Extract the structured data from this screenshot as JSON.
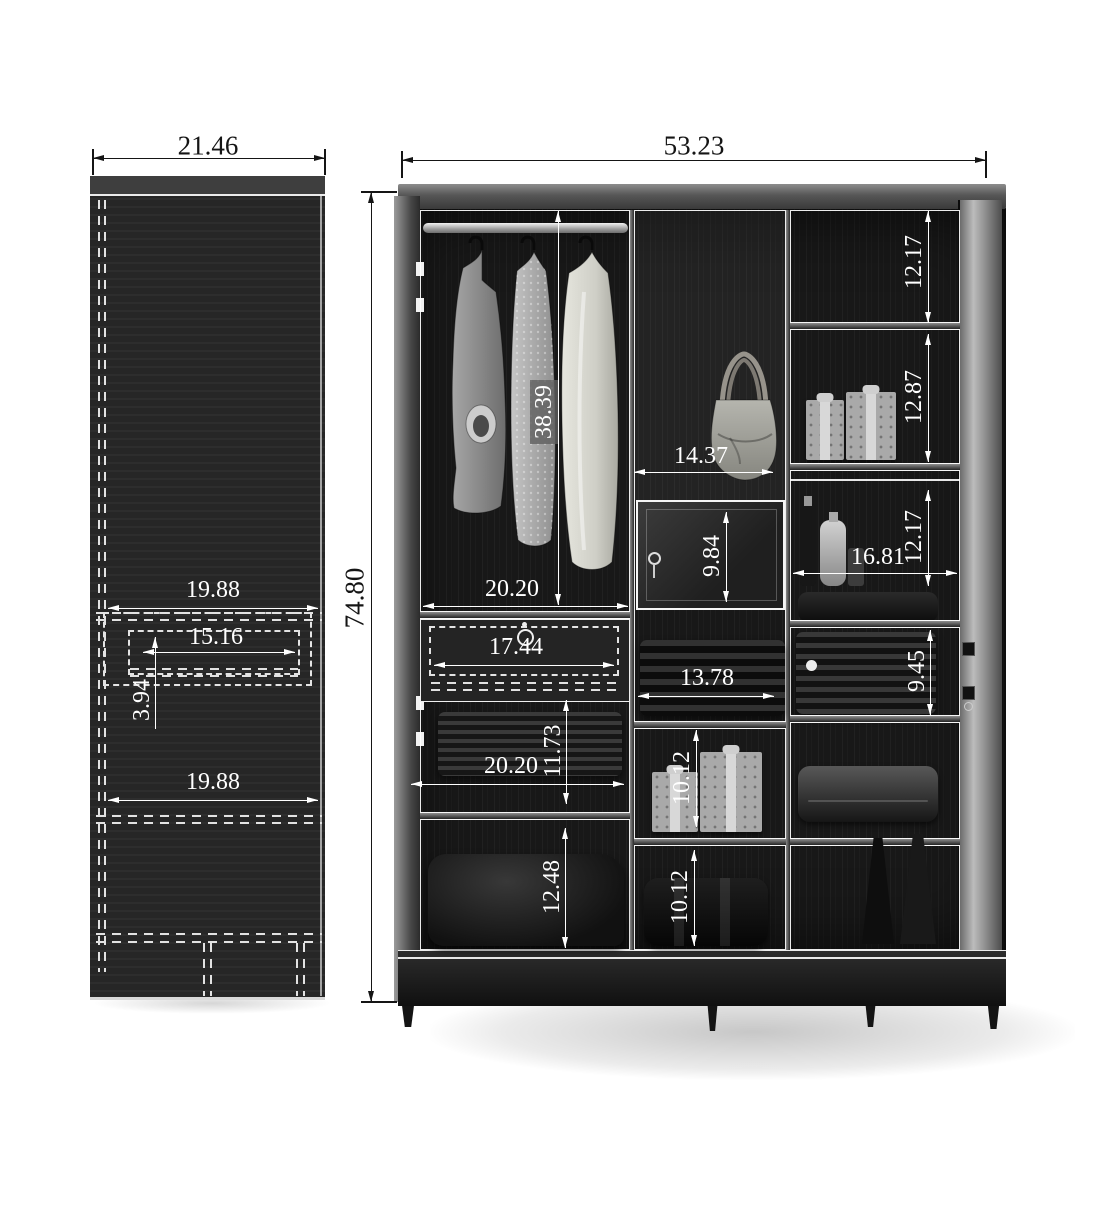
{
  "colors": {
    "background": "#ffffff",
    "dimension_exterior": "#151515",
    "dimension_interior": "#ffffff",
    "carcass_dark": "#1b1b1b",
    "wood_rail": "#6f6f6f"
  },
  "side_view": {
    "overall_width": "21.46",
    "shelf_width_upper": "19.88",
    "drawer_inner_width": "15.16",
    "drawer_height": "3.94",
    "shelf_width_lower": "19.88"
  },
  "front_view": {
    "overall_width": "53.23",
    "overall_height": "74.80",
    "left_bay": {
      "hanging_section_height": "38.39",
      "bay_width_top": "20.20",
      "drawer_width": "17.44",
      "shelf_gap_height": "11.73",
      "bay_width_bottom": "20.20",
      "bottom_shelf_height": "12.48"
    },
    "middle_bay": {
      "bay_width": "14.37",
      "locker_door_height": "9.84",
      "stack_shelf_width": "13.78",
      "upper_shelf_height": "10.12",
      "lower_shelf_height": "10.12"
    },
    "right_bay": {
      "shelf1_height": "12.17",
      "shelf2_height": "12.87",
      "shelf3_height": "12.17",
      "bay_width": "16.81",
      "shelf4_height": "9.45"
    }
  }
}
